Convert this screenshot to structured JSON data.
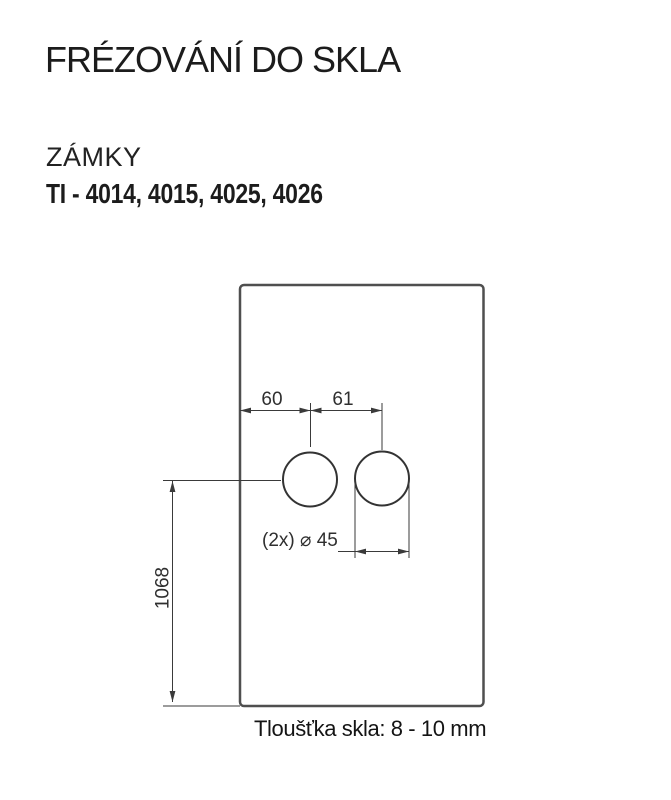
{
  "header": {
    "title": "FRÉZOVÁNÍ DO SKLA",
    "category": "ZÁMKY",
    "models": "TI - 4014, 4015, 4025, 4026"
  },
  "drawing": {
    "type": "technical-drawing",
    "dims": {
      "edge_to_hole1": "60",
      "hole1_to_hole2": "61",
      "holes_diameter": "(2x) ⌀ 45",
      "panel_height": "1068"
    },
    "holes": [
      {
        "name": "hole-1",
        "diameter_mm": 45
      },
      {
        "name": "hole-2",
        "diameter_mm": 45
      }
    ]
  },
  "footer": {
    "thickness_note": "Tloušťka skla: 8 - 10 mm"
  },
  "colors": {
    "background": "#ffffff",
    "text": "#1c1c1c",
    "drawing_line": "#3a3a3a",
    "panel_border": "#4f4f4f"
  }
}
